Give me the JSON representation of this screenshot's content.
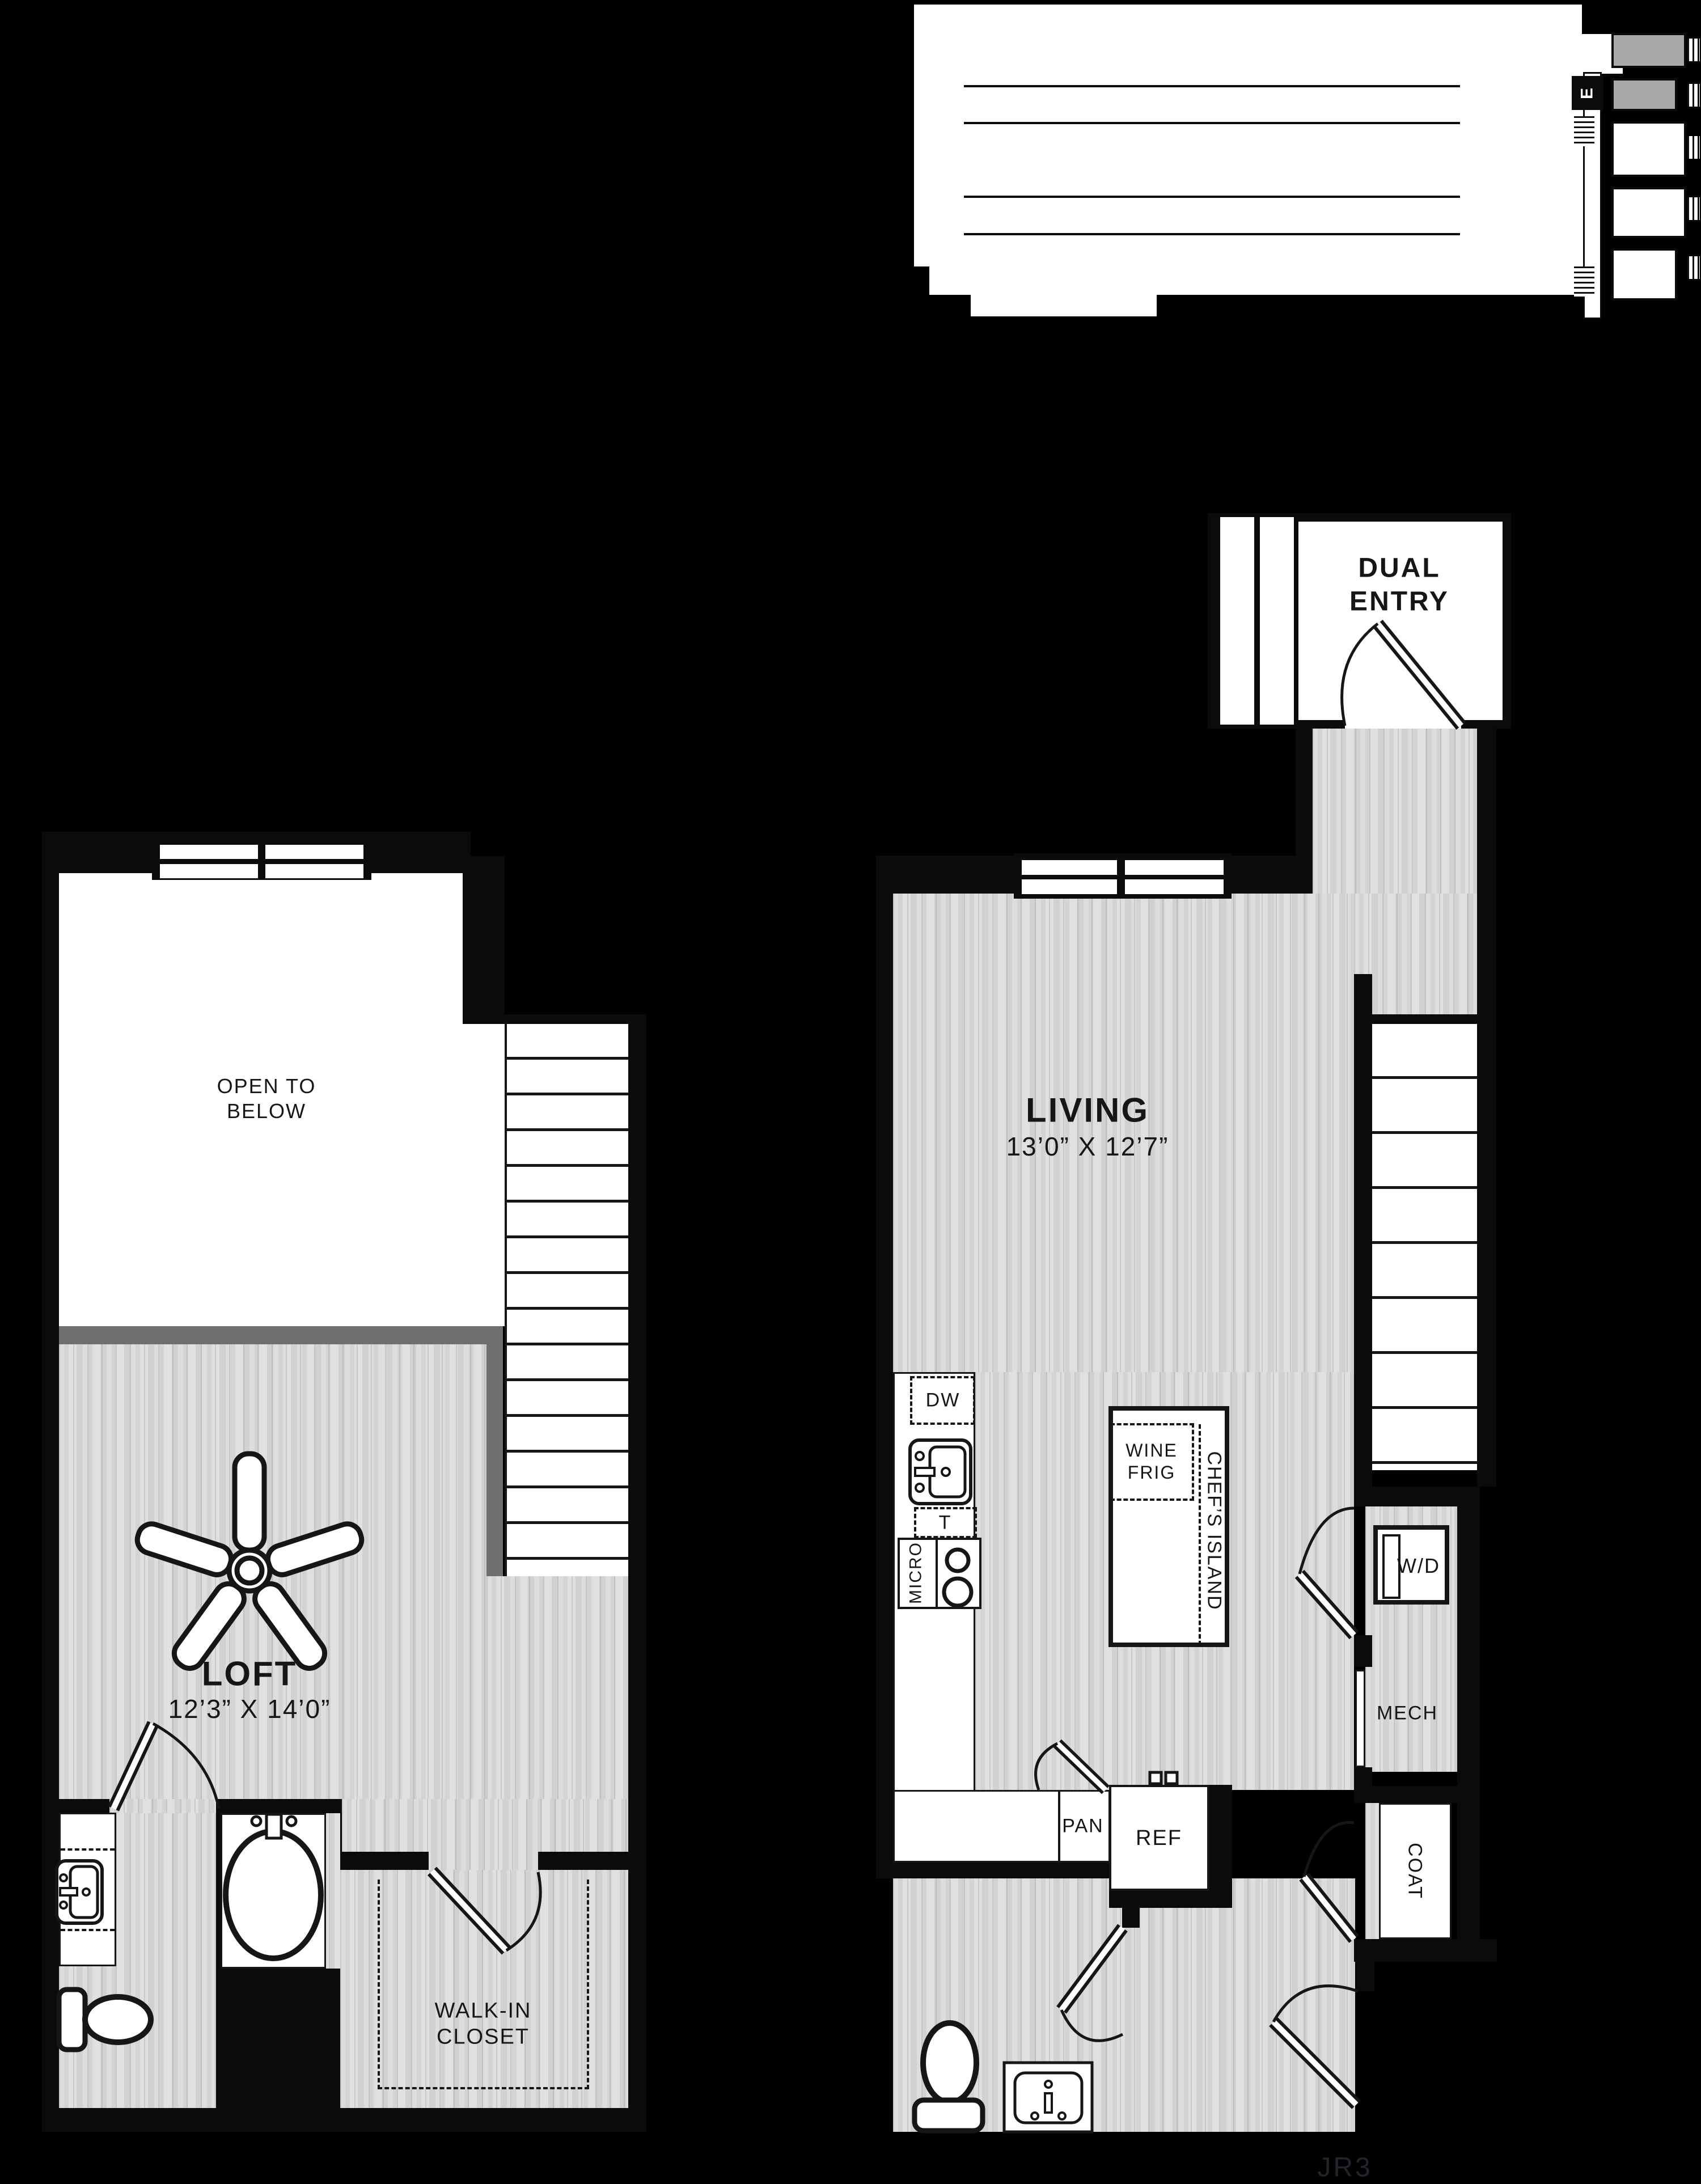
{
  "plan": {
    "code": "JR3"
  },
  "key_plan": {
    "elevator_label": "E"
  },
  "upper_level": {
    "open_to_below": "OPEN TO\nBELOW",
    "loft_name": "LOFT",
    "loft_dims": "12’3” X 14’0”",
    "walk_in_closet": "WALK-IN\nCLOSET"
  },
  "main_level": {
    "dual_entry": "DUAL\nENTRY",
    "living_name": "LIVING",
    "living_dims": "13’0” X 12’7”",
    "kitchen": {
      "dishwasher": "DW",
      "trash": "T",
      "microwave": "MICRO",
      "wine_fridge": "WINE\nFRIG",
      "chefs_island": "CHEF’S ISLAND",
      "pantry": "PAN",
      "refrigerator": "REF"
    },
    "washer_dryer": "W/D",
    "mechanical": "MECH",
    "coat": "COAT"
  },
  "colors": {
    "background": "#000000",
    "floor_gray": "#d8d8d8",
    "half_wall_gray": "#6f6f6f",
    "highlight_unit_gray": "#a9a9a9",
    "line_black": "#161616"
  }
}
